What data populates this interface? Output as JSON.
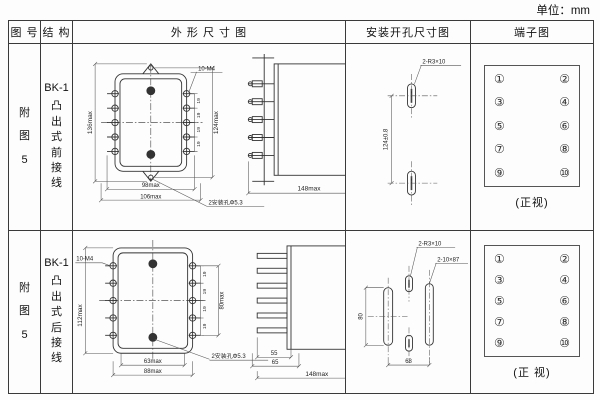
{
  "unit": "单位：mm",
  "headers": {
    "fig": "图 号",
    "struct": "结 构",
    "outline": "外 形 尺 寸 图",
    "mount": "安装开孔尺寸图",
    "terminal": "端子图"
  },
  "rows": [
    {
      "fig": "附图5",
      "model": "BK-1",
      "struct": "凸出式前接线",
      "front": {
        "screws": "10-M4",
        "h_overall": "136max",
        "h_holes": "124max",
        "pitch": "19",
        "w_inner": "98max",
        "w_overall": "106max",
        "holes": "2安装孔Φ5.3"
      },
      "side": {
        "depth": "148max"
      },
      "mount": {
        "slots": "2-R3×10",
        "vdim": "124±0.8"
      },
      "terminal": {
        "nums": [
          "①",
          "②",
          "③",
          "④",
          "⑤",
          "⑥",
          "⑦",
          "⑧",
          "⑨",
          "⑩"
        ],
        "view": "(正视)"
      }
    },
    {
      "fig": "附图5",
      "model": "BK-1",
      "struct": "凸出式后接线",
      "front": {
        "screws": "10-M4",
        "h_overall": "112max",
        "pitch": "19",
        "h_terms": "80max",
        "w_inner": "63max",
        "w_overall": "88max",
        "holes": "2安装孔Φ5.3"
      },
      "side": {
        "d1": "55",
        "d2": "65",
        "depth": "148max"
      },
      "mount": {
        "slots": "2-R3×10",
        "slots2": "2-10×87",
        "vdim": "80",
        "hdim": "68"
      },
      "terminal": {
        "nums": [
          "①",
          "②",
          "③",
          "④",
          "⑤",
          "⑥",
          "⑦",
          "⑧",
          "⑨",
          "⑩"
        ],
        "view": "(正 视)"
      }
    }
  ]
}
